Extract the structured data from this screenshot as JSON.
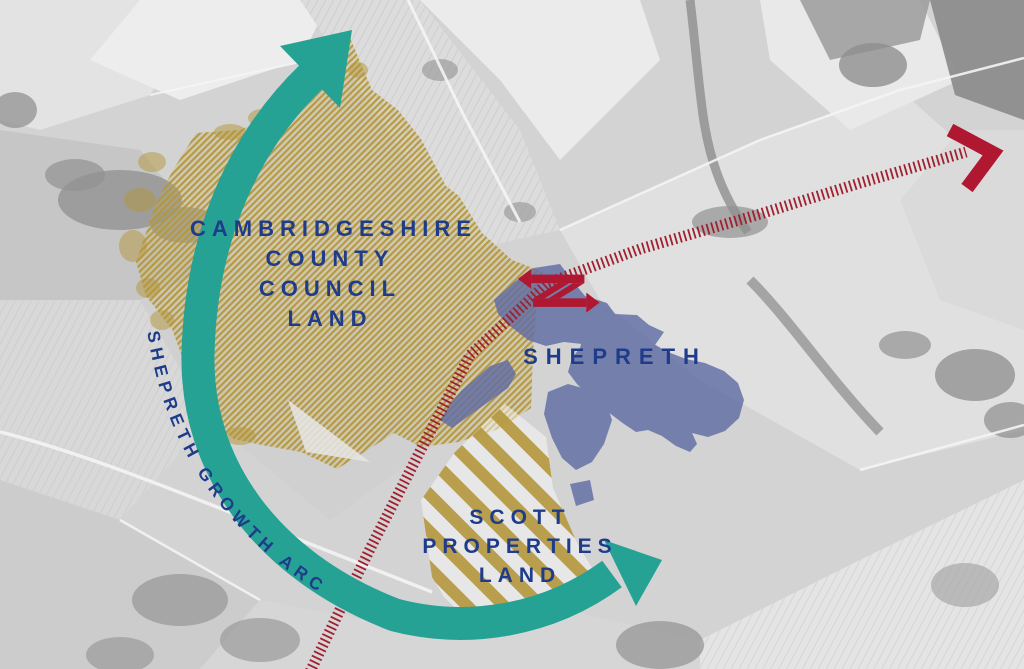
{
  "labels": {
    "ccc_land": "CAMBRIDGESHIRE\nCOUNTY COUNCIL\nLAND",
    "shepreth": "SHEPRETH",
    "scott_land": "SCOTT\nPROPERTIES\nLAND",
    "growth_arc": "SHEPRETH GROWTH ARC"
  },
  "colors": {
    "growth_arc_teal": "#26A295",
    "land_hatch_gold": "#B4973C",
    "settlement_blue": "#606CA3",
    "label_navy": "#1E3C8A",
    "railway_red": "#A02030",
    "station_logo_red": "#B01730"
  },
  "icons": {
    "station": "national-rail-double-arrow",
    "railway_terminus": "chevron-arrow",
    "growth_arc": "curved-double-headed-arrow"
  }
}
